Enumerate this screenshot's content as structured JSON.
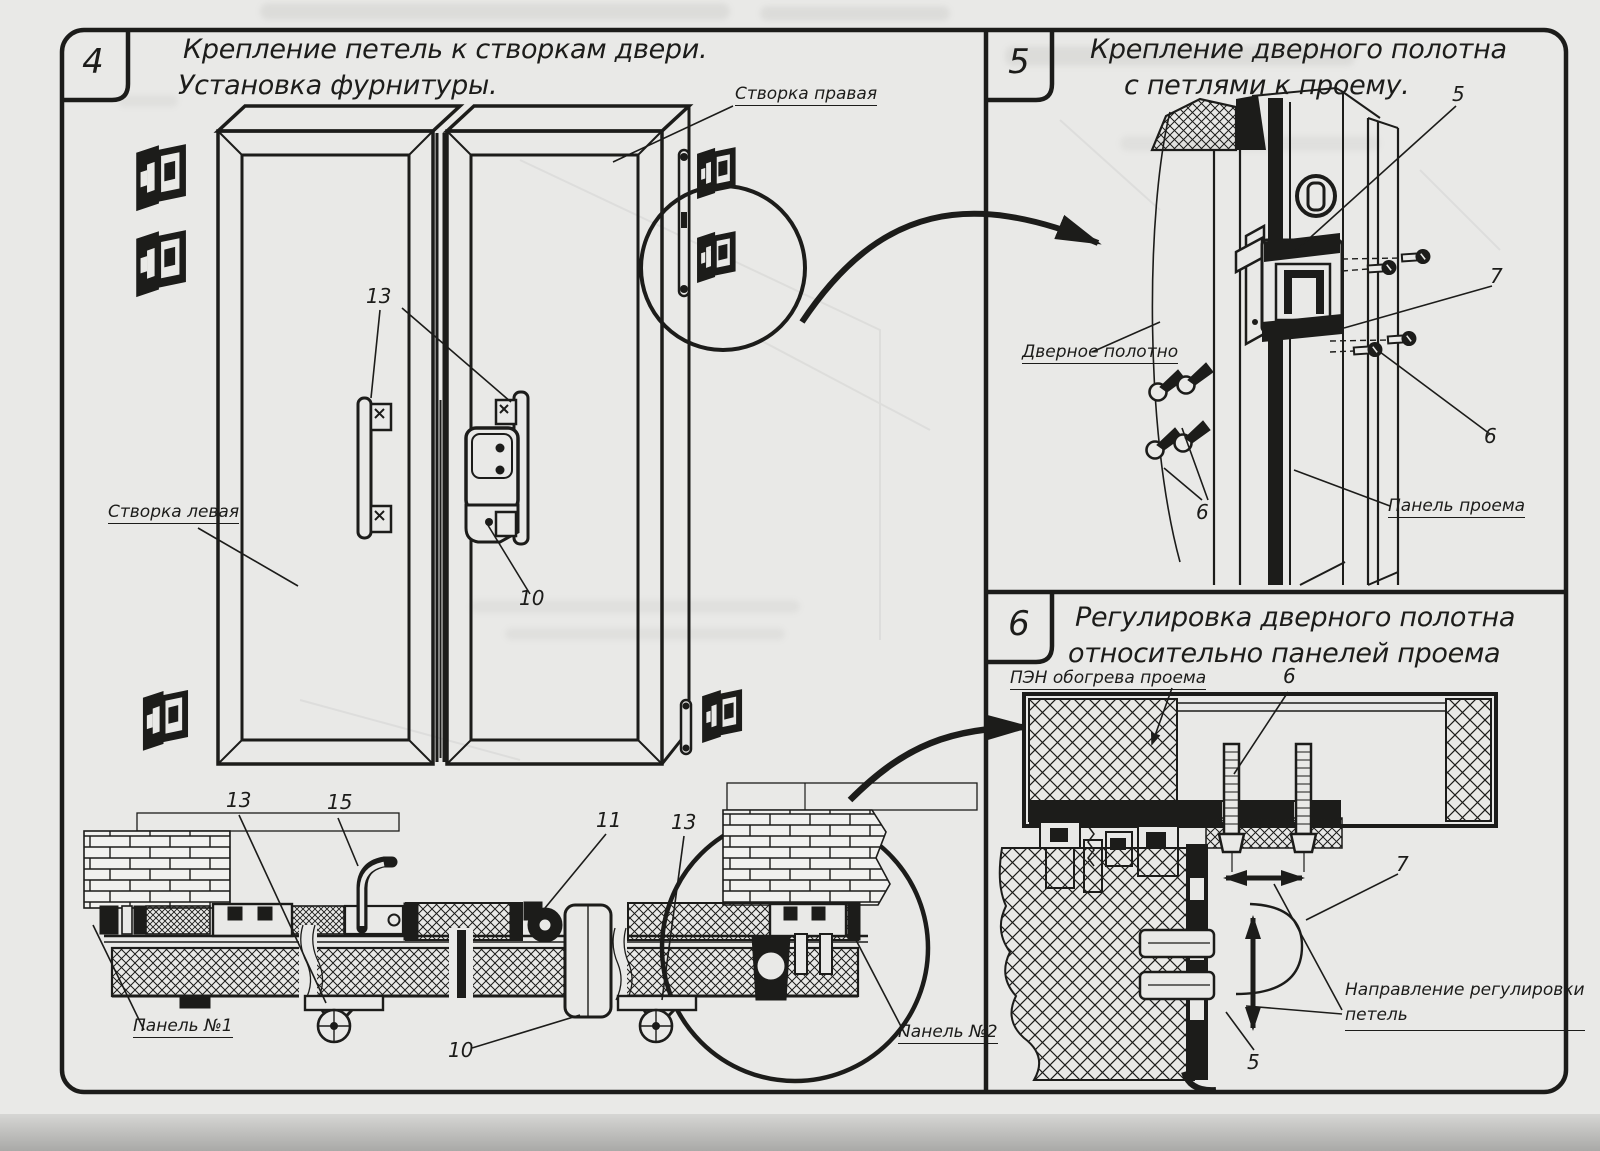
{
  "colors": {
    "ink": "#1c1c1a",
    "paper": "#e9e9e7"
  },
  "panels": {
    "p4": {
      "number": "4",
      "title_line1": "Крепление петель к створкам двери.",
      "title_line2": "Установка фурнитуры.",
      "labels": {
        "stvorka_pravaya": "Створка правая",
        "stvorka_levaya": "Створка левая",
        "n13_top": "13",
        "n10_mid": "10",
        "n13_left": "13",
        "n15": "15",
        "n11": "11",
        "n13_right": "13",
        "n10_bottom": "10",
        "panel1": "Панель №1",
        "panel2": "Панель №2"
      }
    },
    "p5": {
      "number": "5",
      "title_line1": "Крепление дверного полотна",
      "title_line2": "с петлями к проему.",
      "labels": {
        "n5": "5",
        "n7": "7",
        "n6_right": "6",
        "n6_left": "6",
        "door_leaf": "Дверное полотно",
        "opening_panel": "Панель проема"
      }
    },
    "p6": {
      "number": "6",
      "title_line1": "Регулировка дверного полотна",
      "title_line2": "относительно панелей проема",
      "labels": {
        "pen": "ПЭН обогрева проема",
        "n6": "6",
        "n7": "7",
        "n5": "5",
        "direction_line1": "Направление регулировки",
        "direction_line2": "петель"
      }
    }
  }
}
